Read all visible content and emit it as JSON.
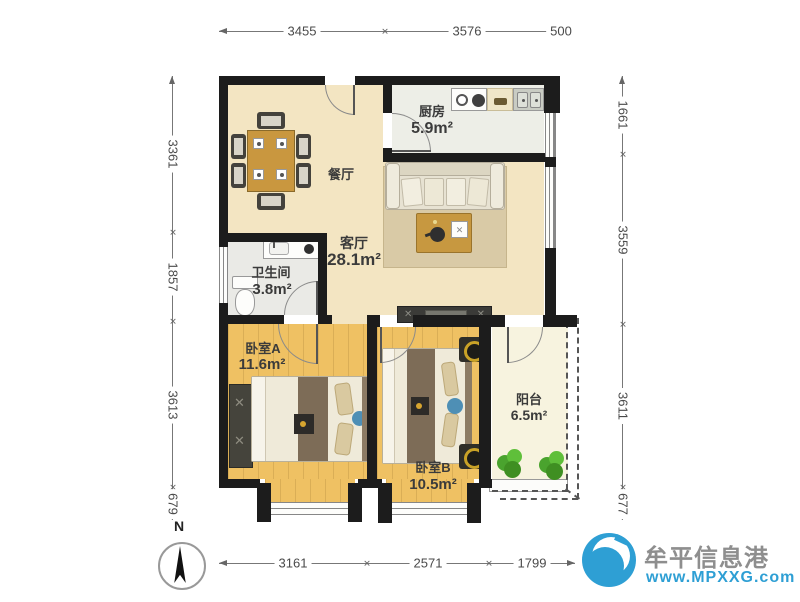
{
  "rooms": [
    {
      "name": "厨房",
      "area": "5.9m²"
    },
    {
      "name": "餐厅",
      "area": ""
    },
    {
      "name": "客厅",
      "area": "28.1m²"
    },
    {
      "name": "卫生间",
      "area": "3.8m²"
    },
    {
      "name": "卧室A",
      "area": "11.6m²"
    },
    {
      "name": "卧室B",
      "area": "10.5m²"
    },
    {
      "name": "阳台",
      "area": "6.5m²"
    }
  ],
  "dimensions": {
    "top": [
      "3455",
      "3576",
      "500"
    ],
    "bottom": [
      "3161",
      "2571",
      "1799"
    ],
    "left": [
      "3361",
      "1857",
      "3613",
      "679"
    ],
    "right": [
      "1661",
      "3559",
      "3611",
      "677"
    ]
  },
  "compass": {
    "label": "N"
  },
  "watermark": {
    "site": "牟平信息港",
    "url": "www.MPXXG.com"
  },
  "colors": {
    "wall": "#1c1c1c",
    "floor_main": "#F3E5C2",
    "floor_wood": "#EFC163",
    "brand_blue": "#2E9FD4",
    "dim_text": "#4a4a4a"
  }
}
